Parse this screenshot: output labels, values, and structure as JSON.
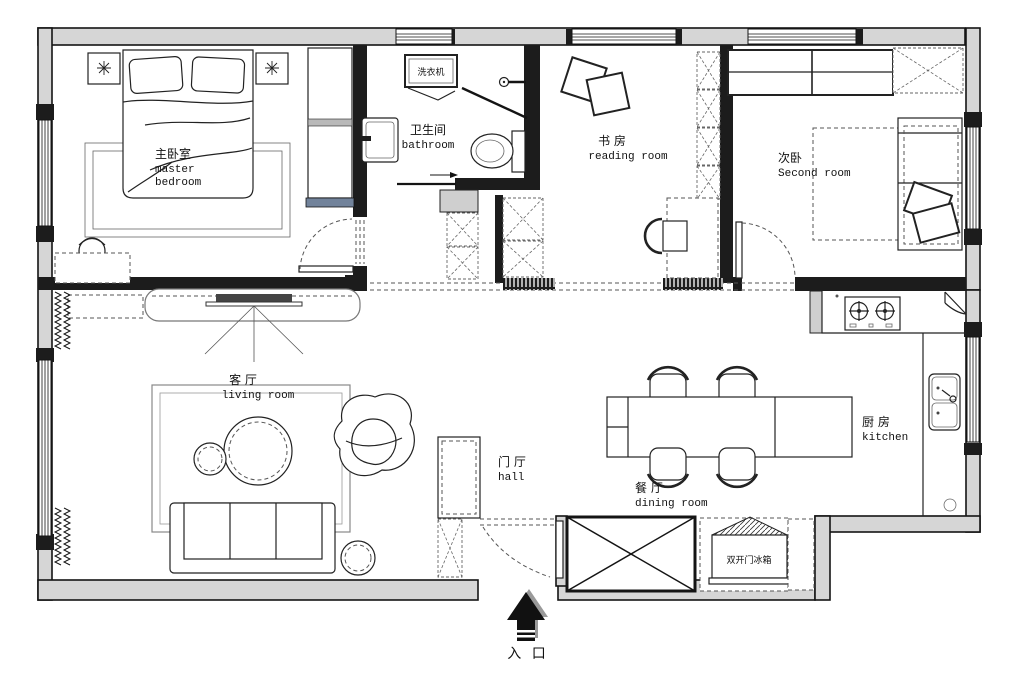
{
  "plan": {
    "title": "apartment floor plan",
    "rooms": {
      "master_bedroom": {
        "zh": "主卧室",
        "en_line1": "master",
        "en_line2": "bedroom"
      },
      "bathroom": {
        "zh": "卫生间",
        "en": "bathroom"
      },
      "reading_room": {
        "zh": "书 房",
        "en": "reading room"
      },
      "second_room": {
        "zh": "次卧",
        "en": "Second room"
      },
      "living_room": {
        "zh": "客 厅",
        "en": "living room"
      },
      "hall": {
        "zh": "门 厅",
        "en": "hall"
      },
      "dining_room": {
        "zh": "餐 厅",
        "en": "dining room"
      },
      "kitchen": {
        "zh": "厨 房",
        "en": "kitchen"
      }
    },
    "appliances": {
      "washing_machine": {
        "zh": "洗衣机"
      },
      "fridge": {
        "zh": "双开门冰箱"
      }
    },
    "entrance": {
      "zh": "入 口"
    },
    "colors": {
      "wall_fill": "#d6d6d6",
      "line": "#1c1c1c",
      "wardrobe_accent": "#72839b"
    }
  }
}
